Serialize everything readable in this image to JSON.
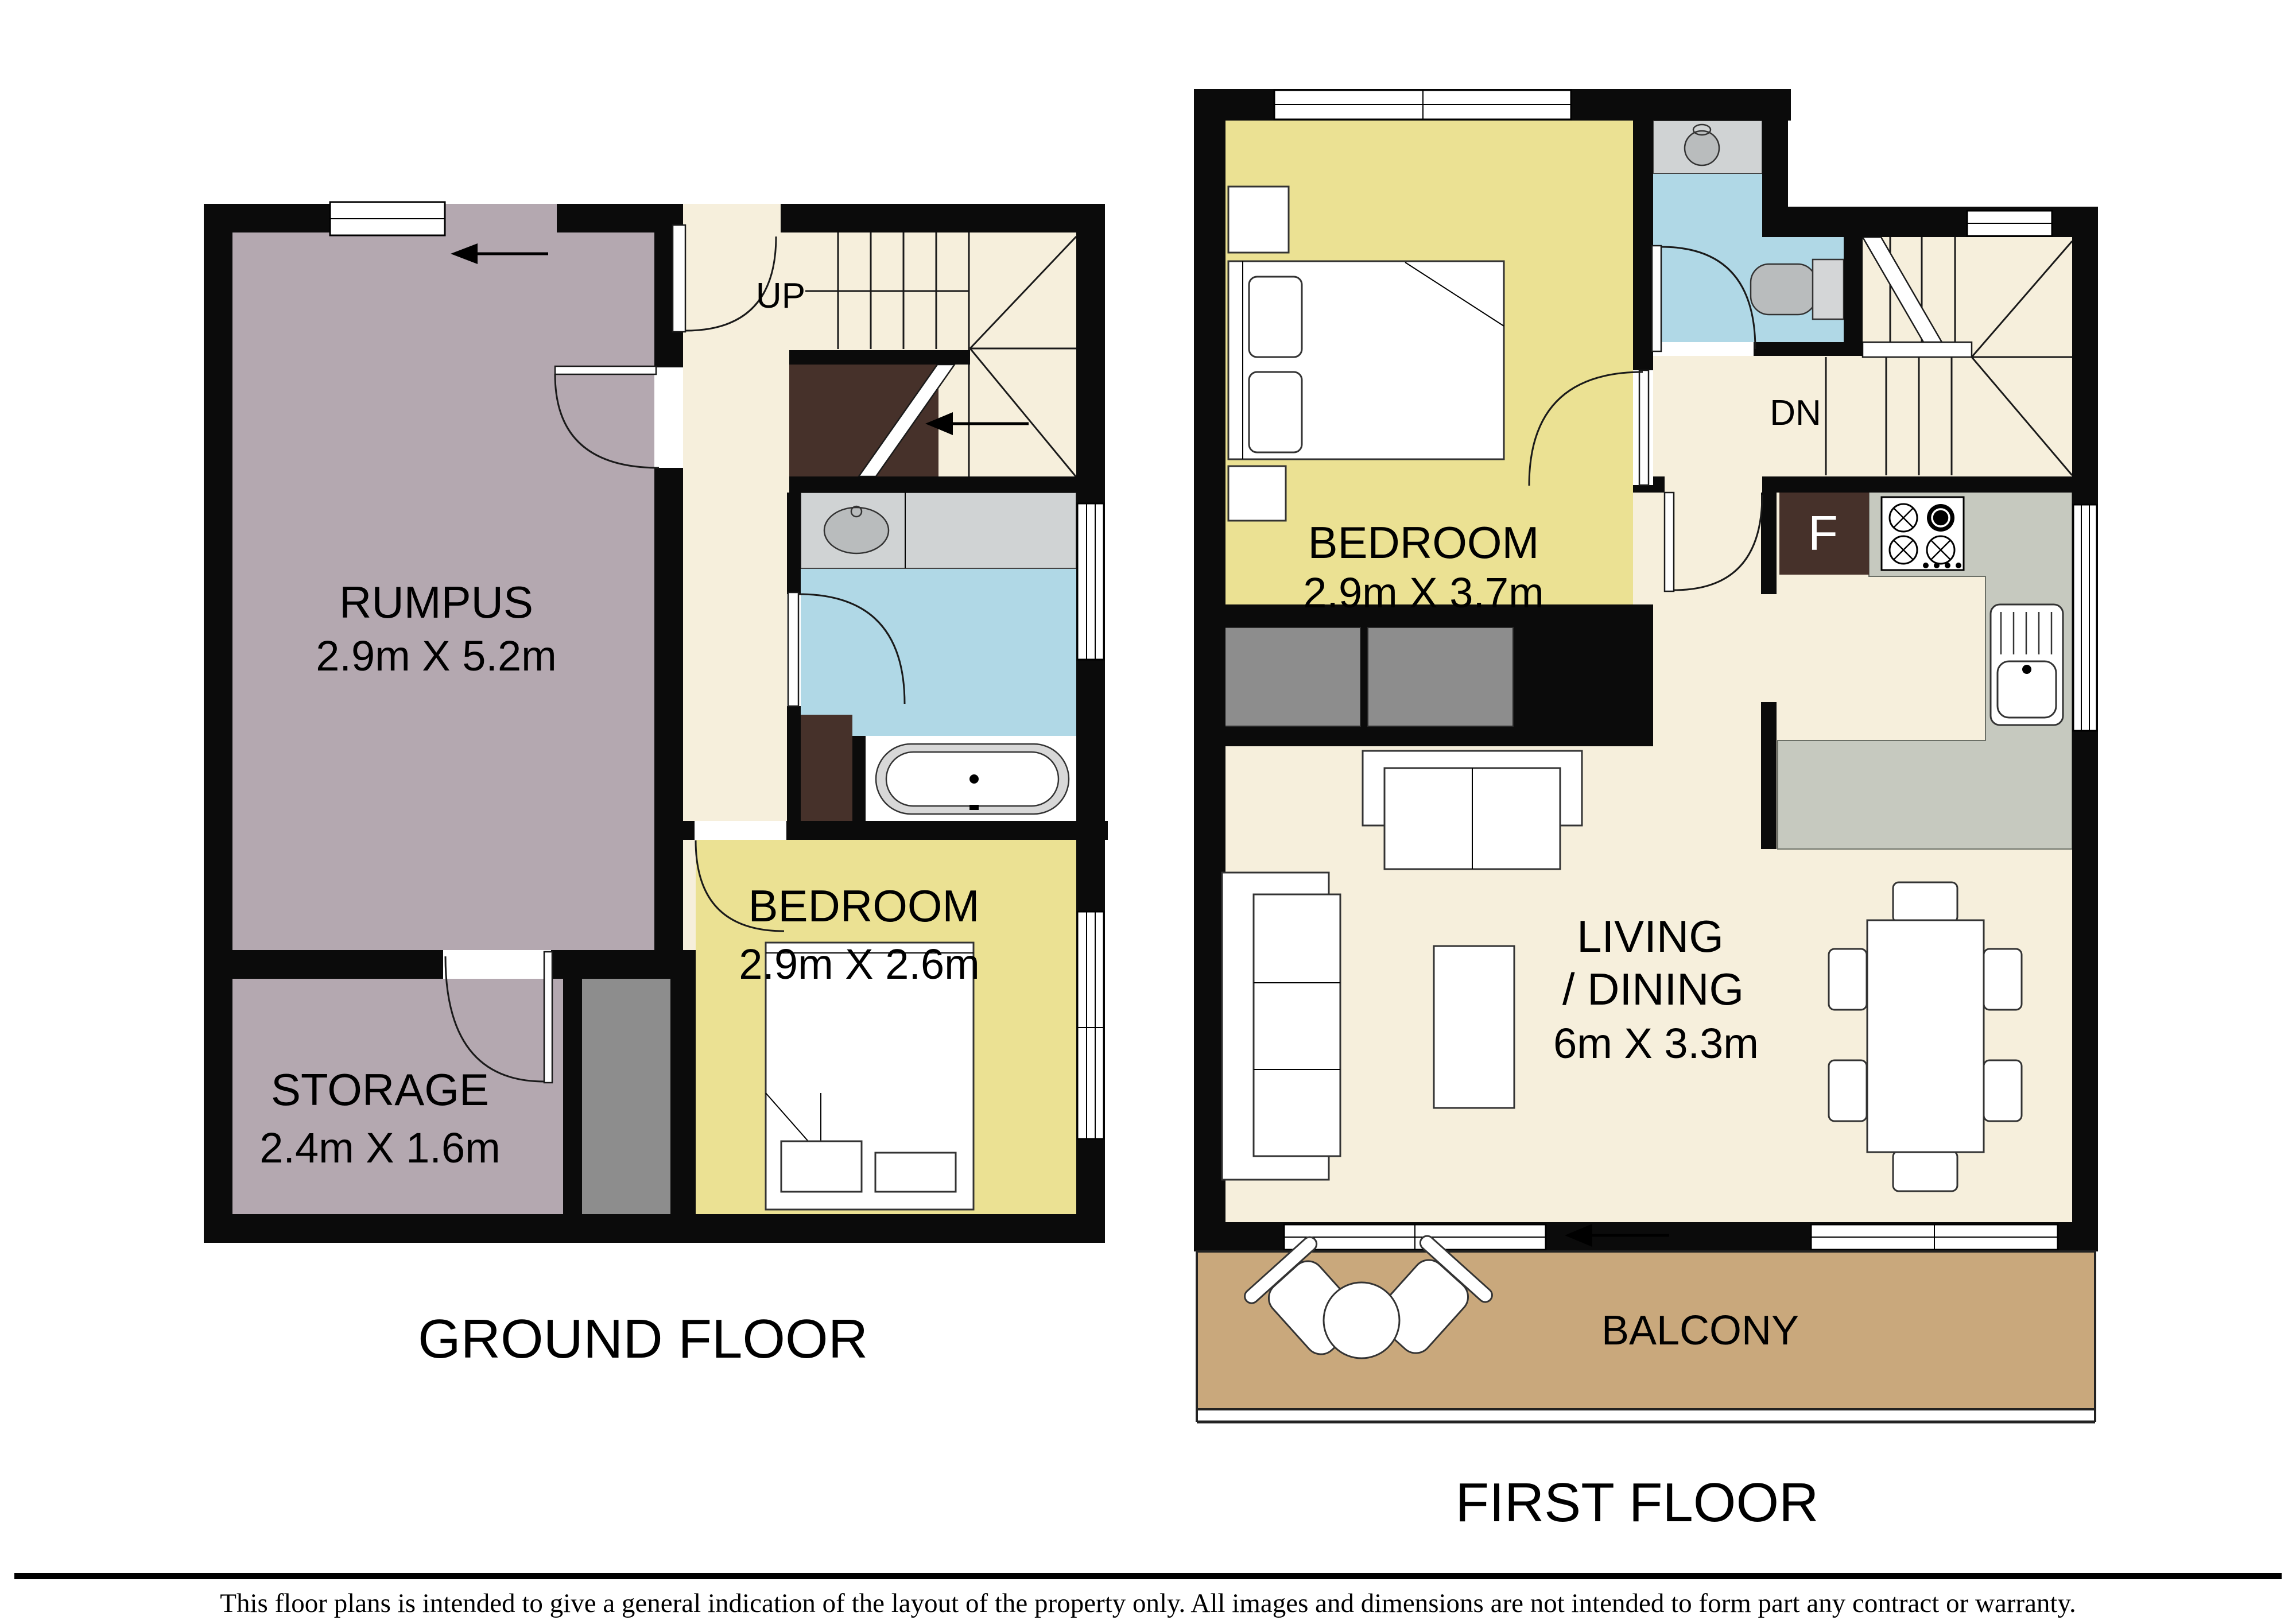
{
  "colors": {
    "wall": "#0b0b0b",
    "floor": "#f6efdc",
    "rumpus": "#b4a8b0",
    "bedroom": "#ebe193",
    "bathroom": "#b0d8e6",
    "balcony": "#c9a87c",
    "counter": "#c6c9bf",
    "vanity": "#d0d3d4",
    "fixture": "#b9bcbd",
    "closet": "#46312a",
    "alcove": "#8d8d8d",
    "window": "#ffffff"
  },
  "ground_floor": {
    "title": "GROUND FLOOR",
    "stairs_label": "UP",
    "rooms": {
      "rumpus": {
        "name": "RUMPUS",
        "dims": "2.9m X 5.2m"
      },
      "storage": {
        "name": "STORAGE",
        "dims": "2.4m X 1.6m"
      },
      "bedroom": {
        "name": "BEDROOM",
        "dims": "2.9m X 2.6m"
      }
    }
  },
  "first_floor": {
    "title": "FIRST FLOOR",
    "stairs_label": "DN",
    "fridge_label": "F",
    "rooms": {
      "bedroom": {
        "name": "BEDROOM",
        "dims": "2.9m X 3.7m"
      },
      "living": {
        "name": "LIVING",
        "name2": "/ DINING",
        "dims": "6m X 3.3m"
      },
      "balcony": {
        "name": "BALCONY"
      }
    }
  },
  "footer": {
    "disclaimer": "This floor plans is intended to give a general indication of the layout of the property only. All images and dimensions are not intended to form part any contract or warranty."
  }
}
